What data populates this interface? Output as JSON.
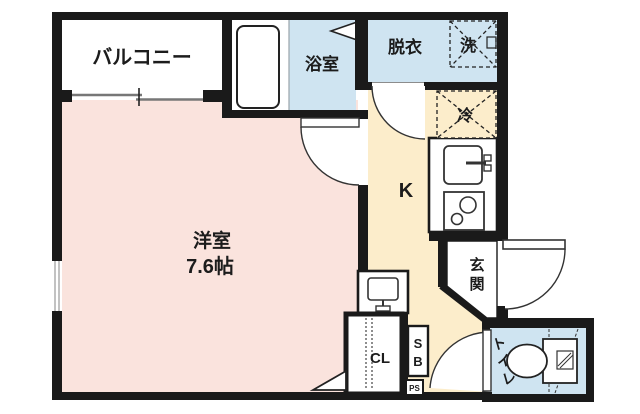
{
  "plan": {
    "type": "apartment-floor-plan",
    "labels": {
      "balcony": "バルコニー",
      "bathroom": "浴室",
      "dressing_room": "脱衣",
      "washer": "洗",
      "fridge": "冷",
      "kitchen": "K",
      "main_room_name": "洋室",
      "main_room_size": "7.6帖",
      "entrance": "玄関",
      "closet": "CL",
      "shoe_box": "SB",
      "pipe_space": "PS",
      "toilet": "トイレ"
    },
    "colors": {
      "wall": "#1a1a1a",
      "room_pink": "#fae3dd",
      "kitchen_cream": "#fcedcb",
      "wet_area_blue": "#cfe4f1",
      "white": "#ffffff",
      "line_gray": "#8a8a8a"
    }
  }
}
